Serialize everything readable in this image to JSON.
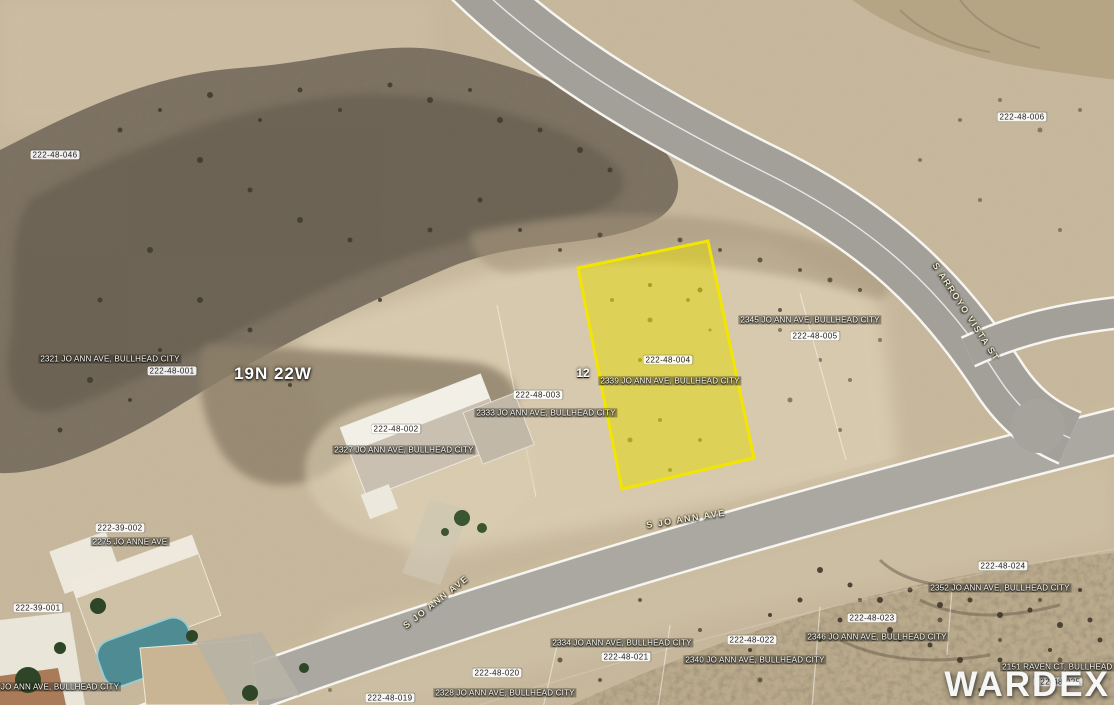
{
  "map": {
    "township_range": "19N 22W",
    "section_lot": "12",
    "watermark": "WARDEX",
    "highlighted_parcel": {
      "apn": "222-48-004",
      "address": "2339 JO ANN AVE, BULLHEAD CITY",
      "fill_color": "#e6da00",
      "border_color": "#f2e600"
    },
    "labels": [
      {
        "text": "222-48-046",
        "x": 55,
        "y": 155,
        "rot": 0,
        "style": "parcel-id"
      },
      {
        "text": "222-48-006",
        "x": 1022,
        "y": 117,
        "rot": 0,
        "style": "parcel-id"
      },
      {
        "text": "S ARROYO VISTA ST",
        "x": 966,
        "y": 312,
        "rot": 57,
        "style": "road"
      },
      {
        "text": "2345 JO ANN AVE, BULLHEAD CITY",
        "x": 810,
        "y": 320,
        "rot": 0,
        "style": "address"
      },
      {
        "text": "222-48-005",
        "x": 815,
        "y": 336,
        "rot": 0,
        "style": "parcel-id"
      },
      {
        "text": "2321 JO ANN AVE, BULLHEAD CITY",
        "x": 110,
        "y": 359,
        "rot": 0,
        "style": "address"
      },
      {
        "text": "222-48-001",
        "x": 172,
        "y": 371,
        "rot": 0,
        "style": "parcel-id"
      },
      {
        "text": "19N 22W",
        "x": 273,
        "y": 374,
        "rot": 0,
        "style": "section"
      },
      {
        "text": "12",
        "x": 583,
        "y": 374,
        "rot": 0,
        "style": "lot-number"
      },
      {
        "text": "222-48-004",
        "x": 668,
        "y": 360,
        "rot": 0,
        "style": "parcel-id"
      },
      {
        "text": "2339 JO ANN AVE, BULLHEAD CITY",
        "x": 670,
        "y": 381,
        "rot": 0,
        "style": "address"
      },
      {
        "text": "222-48-003",
        "x": 538,
        "y": 395,
        "rot": 0,
        "style": "parcel-id"
      },
      {
        "text": "2333 JO ANN AVE, BULLHEAD CITY",
        "x": 546,
        "y": 413,
        "rot": 0,
        "style": "address"
      },
      {
        "text": "222-48-002",
        "x": 396,
        "y": 429,
        "rot": 0,
        "style": "parcel-id"
      },
      {
        "text": "2327 JO ANN AVE, BULLHEAD CITY",
        "x": 404,
        "y": 450,
        "rot": 0,
        "style": "address"
      },
      {
        "text": "S JO ANN AVE",
        "x": 686,
        "y": 519,
        "rot": -9,
        "style": "road"
      },
      {
        "text": "222-39-002",
        "x": 120,
        "y": 528,
        "rot": 0,
        "style": "parcel-id"
      },
      {
        "text": "2275 JO ANNE AVE",
        "x": 130,
        "y": 542,
        "rot": 0,
        "style": "address"
      },
      {
        "text": "S JO ANN AVE",
        "x": 436,
        "y": 602,
        "rot": -38,
        "style": "road"
      },
      {
        "text": "222-39-001",
        "x": 38,
        "y": 608,
        "rot": 0,
        "style": "parcel-id"
      },
      {
        "text": "JO ANN AVE, BULLHEAD CITY",
        "x": 60,
        "y": 687,
        "rot": 0,
        "style": "address"
      },
      {
        "text": "2334 JO ANN AVE, BULLHEAD CITY",
        "x": 622,
        "y": 643,
        "rot": 0,
        "style": "address"
      },
      {
        "text": "222-48-021",
        "x": 626,
        "y": 657,
        "rot": 0,
        "style": "parcel-id"
      },
      {
        "text": "222-48-020",
        "x": 497,
        "y": 673,
        "rot": 0,
        "style": "parcel-id"
      },
      {
        "text": "2328 JO ANN AVE, BULLHEAD CITY",
        "x": 505,
        "y": 693,
        "rot": 0,
        "style": "address"
      },
      {
        "text": "222-48-019",
        "x": 390,
        "y": 698,
        "rot": 0,
        "style": "parcel-id"
      },
      {
        "text": "222-48-022",
        "x": 752,
        "y": 640,
        "rot": 0,
        "style": "parcel-id"
      },
      {
        "text": "2340 JO ANN AVE, BULLHEAD CITY",
        "x": 755,
        "y": 660,
        "rot": 0,
        "style": "address"
      },
      {
        "text": "222-48-023",
        "x": 872,
        "y": 618,
        "rot": 0,
        "style": "parcel-id"
      },
      {
        "text": "2346 JO ANN AVE, BULLHEAD CITY",
        "x": 877,
        "y": 637,
        "rot": 0,
        "style": "address"
      },
      {
        "text": "222-48-024",
        "x": 1003,
        "y": 566,
        "rot": 0,
        "style": "parcel-id"
      },
      {
        "text": "2352 JO ANN AVE, BULLHEAD CITY",
        "x": 1000,
        "y": 588,
        "rot": 0,
        "style": "address"
      },
      {
        "text": "2151 RAVEN CT, BULLHEAD CITY",
        "x": 1068,
        "y": 667,
        "rot": 0,
        "style": "address"
      },
      {
        "text": "222-48-025",
        "x": 1058,
        "y": 682,
        "rot": 0,
        "style": "parcel-id"
      }
    ]
  }
}
